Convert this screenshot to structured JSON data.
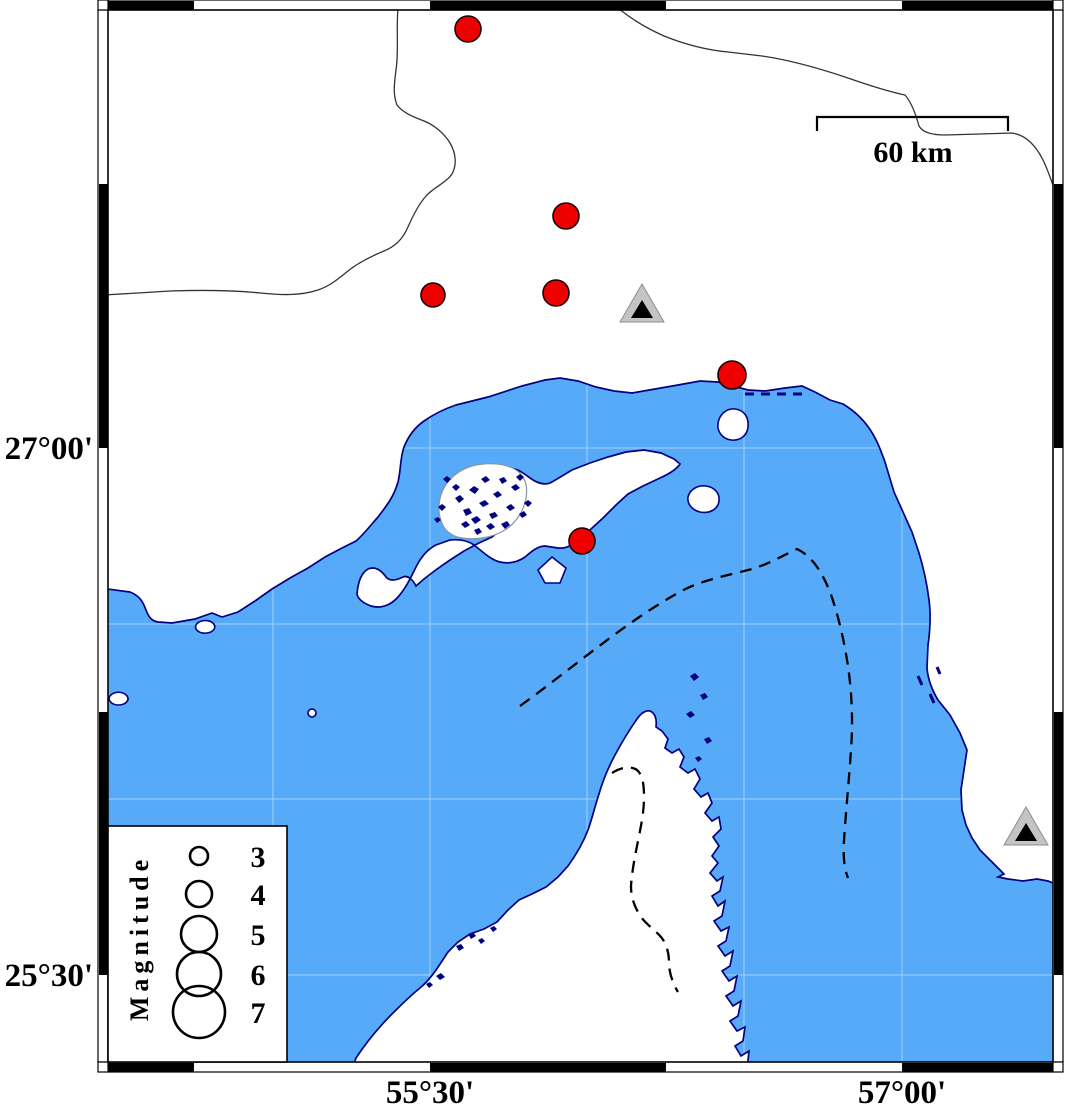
{
  "map": {
    "axis_labels": {
      "left": [
        {
          "text": "27°00'",
          "y": 448
        },
        {
          "text": "25°30'",
          "y": 975
        }
      ],
      "bottom": [
        {
          "text": "55°30'",
          "x": 430
        },
        {
          "text": "57°00'",
          "x": 902
        }
      ]
    },
    "scale_bar": {
      "label": "60 km"
    },
    "legend": {
      "title": "Magnitude",
      "entries": [
        {
          "label": "3",
          "radius": 9
        },
        {
          "label": "4",
          "radius": 13
        },
        {
          "label": "5",
          "radius": 18
        },
        {
          "label": "6",
          "radius": 22
        },
        {
          "label": "7",
          "radius": 26
        }
      ]
    },
    "epicenters": [
      {
        "x": 468,
        "y": 29,
        "radius": 13
      },
      {
        "x": 566,
        "y": 216,
        "radius": 13
      },
      {
        "x": 433,
        "y": 295,
        "radius": 12
      },
      {
        "x": 556,
        "y": 293,
        "radius": 13
      },
      {
        "x": 732,
        "y": 375,
        "radius": 14
      },
      {
        "x": 582,
        "y": 541,
        "radius": 13
      }
    ],
    "stations": [
      {
        "x": 642,
        "y": 305
      },
      {
        "x": 1026,
        "y": 828
      }
    ],
    "colors": {
      "sea": "#57aaf8",
      "coastline": "#000080",
      "land": "#ffffff",
      "epicenter_fill": "#ee0000",
      "epicenter_stroke": "#1a0000",
      "station_inner": "#000000",
      "station_outer": "#c4c4c4",
      "frame_black": "#000000",
      "frame_white": "#ffffff"
    }
  }
}
